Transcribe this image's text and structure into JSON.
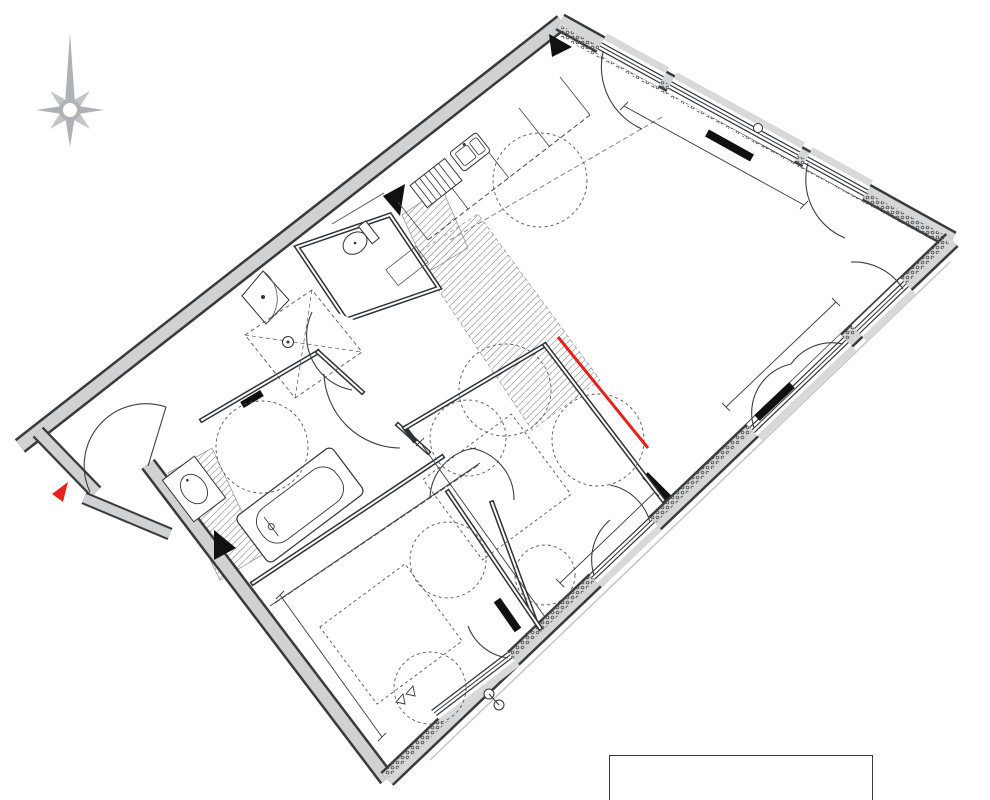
{
  "compass": {
    "n": "N",
    "o": "O",
    "e": "E",
    "s": "Sud"
  },
  "marker": {
    "type": "3P",
    "lot": "9F 32"
  },
  "rooms": {
    "sejour": "SEJOUR / CUISINE",
    "entree": "ENTREE",
    "wc": "WC",
    "sdb": "S.de B.",
    "ch1": "CHAMBRE 1",
    "ch2": "CHAMBRE 2",
    "pl": "PL"
  },
  "kitchen": {
    "lv": "LV",
    "tri": "TRI",
    "ll": "LL",
    "cui": "CUI",
    "r": "R"
  },
  "annotations": {
    "gtl": "GTL",
    "attentes": "Attentes",
    "tablette1": "Tablette",
    "tablette2": "Ht:1.30m",
    "hand1": "Hand",
    "hand2": "1.25x1.25",
    "emprise": "Emprise Carrelage",
    "ep": "EP"
  },
  "openings": {
    "pf": "PF",
    "f": "F",
    "vr": "VR",
    "all10": "All.10",
    "all60": "All.60"
  },
  "dims": {
    "sejour_top": "6.79",
    "sejour_right": "5.76",
    "ch2_se": "3.12",
    "ch2_w": "3.90",
    "pl": "3.18",
    "ch1_w": "2.57",
    "red": "2.50m"
  },
  "legend": {
    "items": [
      {
        "key": "VR:",
        "label": "Volet Roulant Electrique"
      },
      {
        "key": "F:",
        "label": "Fenêtre"
      },
      {
        "key": "PF:",
        "label": "Porte Fenêtre"
      }
    ]
  },
  "nota": {
    "title": "NOTA",
    "lines": [
      "Les cotations sont indicatives, celles ci peuvent varier en fonction de l'exécution.",
      "Les surfaces de placard sont incluses dans celles des pièces attenantes.",
      "Des modifications sont susceptibles d'être apportées à ce plan en fonction des"
    ]
  },
  "colors": {
    "accent_red": "#e4231d",
    "wall_gray": "#cfd1d2",
    "compass_gray": "#9aa0a6",
    "ink": "#2f3235"
  }
}
